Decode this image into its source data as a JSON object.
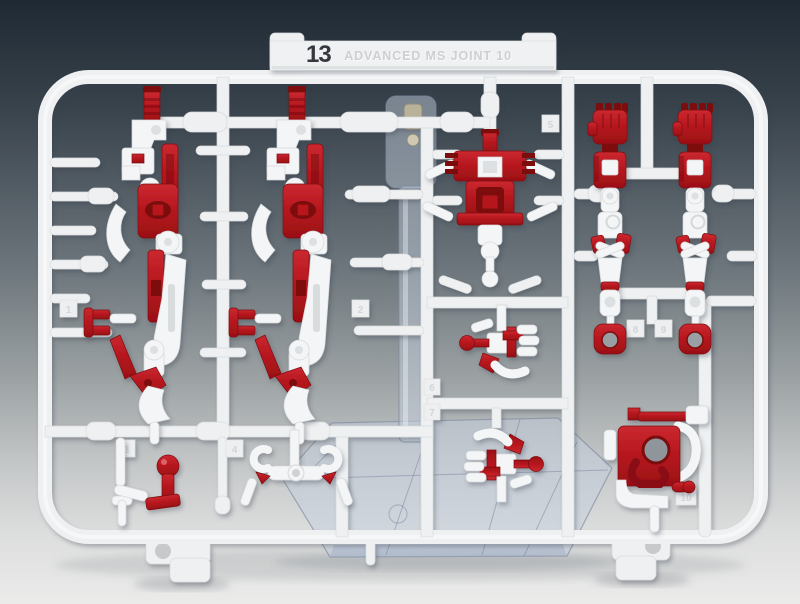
{
  "scene": {
    "type": "product-photo",
    "subject": "Plastic model kit runner sprue (red and white parts) photographed on a gradient backdrop with a clear action base behind it",
    "tag": {
      "number": "13",
      "name": "ADVANCED MS JOINT 10"
    },
    "cells": {
      "labels": [
        "1",
        "2",
        "3",
        "4",
        "5",
        "6",
        "7",
        "8",
        "9",
        "10"
      ]
    },
    "colors": {
      "background_top": "#222c36",
      "background_bottom": "#ebebea",
      "runner_white": "#eef0f1",
      "part_white": "#f3f5f6",
      "part_red": "#b5161d",
      "part_red_dark": "#7d0d11",
      "clear_part": "#c4ced8"
    }
  }
}
